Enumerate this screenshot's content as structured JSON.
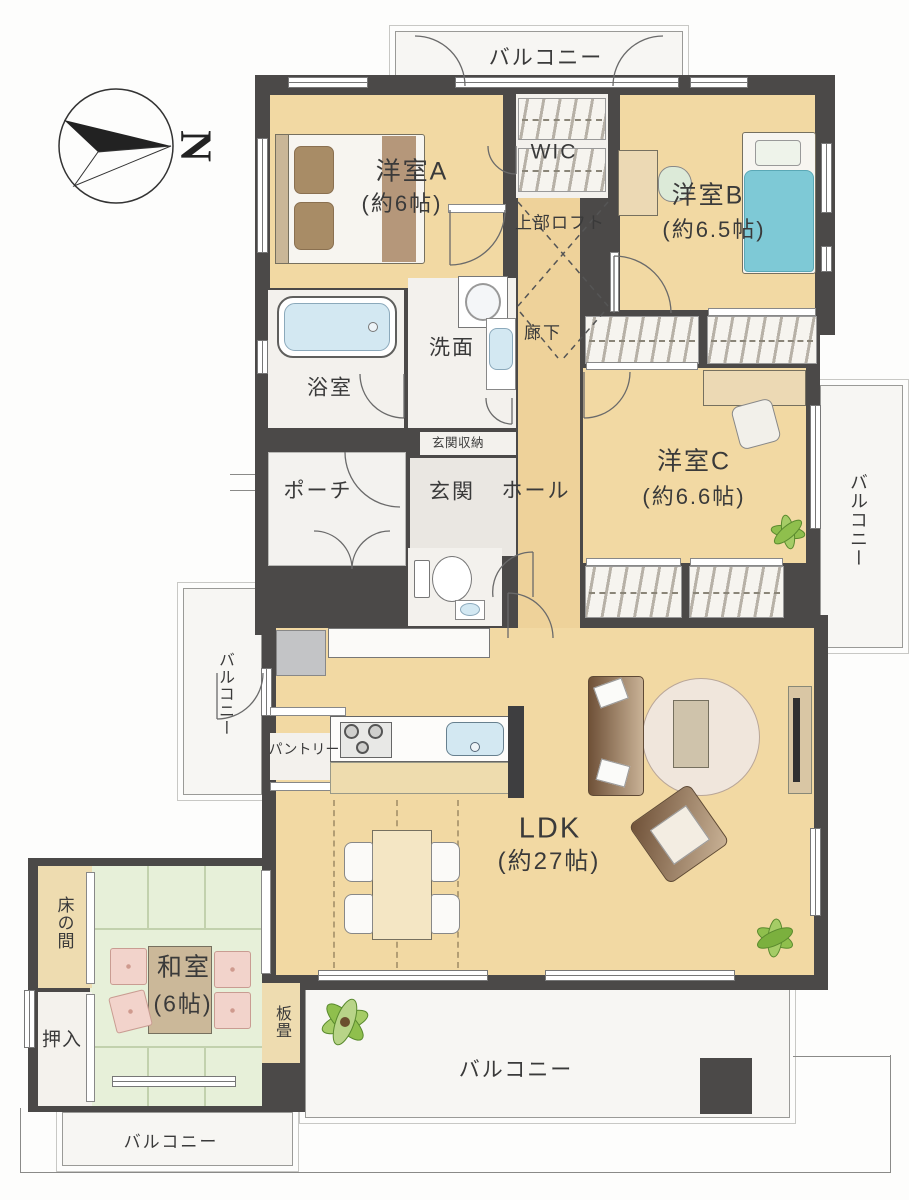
{
  "compass": {
    "label": "N"
  },
  "rooms": {
    "western_a": {
      "name": "洋室A",
      "size": "(約6帖)"
    },
    "western_b": {
      "name": "洋室B",
      "size": "(約6.5帖)"
    },
    "western_c": {
      "name": "洋室C",
      "size": "(約6.6帖)"
    },
    "ldk": {
      "name": "LDK",
      "size": "(約27帖)"
    },
    "japanese": {
      "name": "和室",
      "size": "(6帖)"
    },
    "wic": {
      "name": "WIC"
    },
    "loft": {
      "name": "上部ロフト"
    },
    "bathroom": {
      "name": "浴室"
    },
    "washroom": {
      "name": "洗面"
    },
    "corridor": {
      "name": "廊下"
    },
    "entrance_storage": {
      "name": "玄関収納"
    },
    "entrance": {
      "name": "玄関"
    },
    "porch": {
      "name": "ポーチ"
    },
    "hall": {
      "name": "ホール"
    },
    "pantry": {
      "name": "パントリー"
    },
    "tokonoma": {
      "name": "床の間"
    },
    "oshiire": {
      "name": "押入"
    },
    "itadatami": {
      "name": "板畳"
    }
  },
  "balconies": {
    "top": {
      "name": "バルコニー"
    },
    "right": {
      "name": "バルコニー"
    },
    "left": {
      "name": "バルコニー"
    },
    "bottom": {
      "name": "バルコニー"
    },
    "bottom_left": {
      "name": "バルコニー"
    }
  },
  "colors": {
    "wall": "#4b4948",
    "wood": "#f2d9a3",
    "wood2": "#eed29a",
    "tatami": "#e7f0d9",
    "tatamiline": "#c2d1ad",
    "wroom": "#f3f1ed",
    "balcony": "#f7f6f3",
    "water": "#d3e8f2",
    "bedblue": "#7ec9d6",
    "cushion": "#f2d3cb",
    "sofadark": "#6f5138",
    "sofalight": "#c9b296",
    "plant": "#8fbf4d",
    "desk": "#ecd9b4",
    "label": "#3a3a3a"
  }
}
